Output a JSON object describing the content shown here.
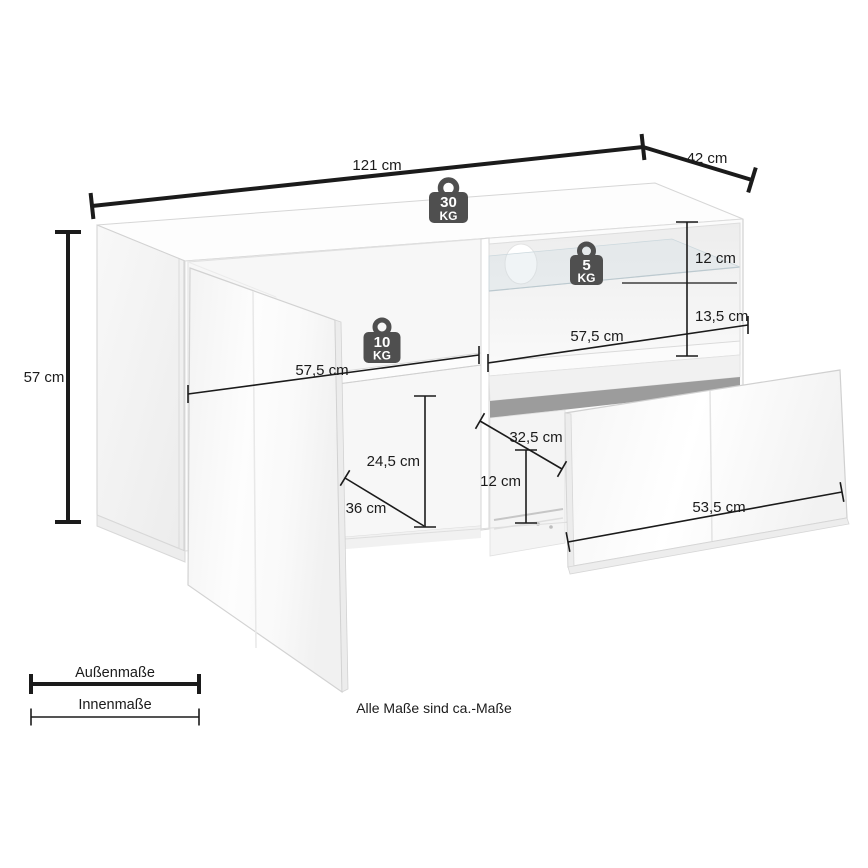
{
  "diagram_type": "furniture-dimension-drawing",
  "outer_dimensions": {
    "width": "121 cm",
    "depth": "42 cm",
    "height": "57 cm"
  },
  "inner_dimensions": {
    "right_shelf_height": "12 cm",
    "right_lower_height": "13,5 cm",
    "right_compartment_width": "57,5 cm",
    "left_compartment_width": "57,5 cm",
    "left_lower_height": "24,5 cm",
    "left_compartment_depth": "36 cm",
    "drawer_inner_depth": "32,5 cm",
    "drawer_inner_height": "12 cm",
    "drawer_front_width": "53,5 cm"
  },
  "load_capacity": {
    "top": {
      "value": "30",
      "unit": "KG"
    },
    "glass_shelf": {
      "value": "5",
      "unit": "KG"
    },
    "left_shelf": {
      "value": "10",
      "unit": "KG"
    }
  },
  "legend": {
    "outer_label": "Außenmaße",
    "inner_label": "Innenmaße"
  },
  "footnote": "Alle Maße sind ca.-Maße",
  "colors": {
    "background": "#ffffff",
    "dimension_lines": "#1b1b1b",
    "weight_icon": "#4f4f4f",
    "furniture_outline": "#d4d4d4",
    "drawer_opening_shadow": "#9c9c9c",
    "glass_tint": "#c6d2d8"
  }
}
